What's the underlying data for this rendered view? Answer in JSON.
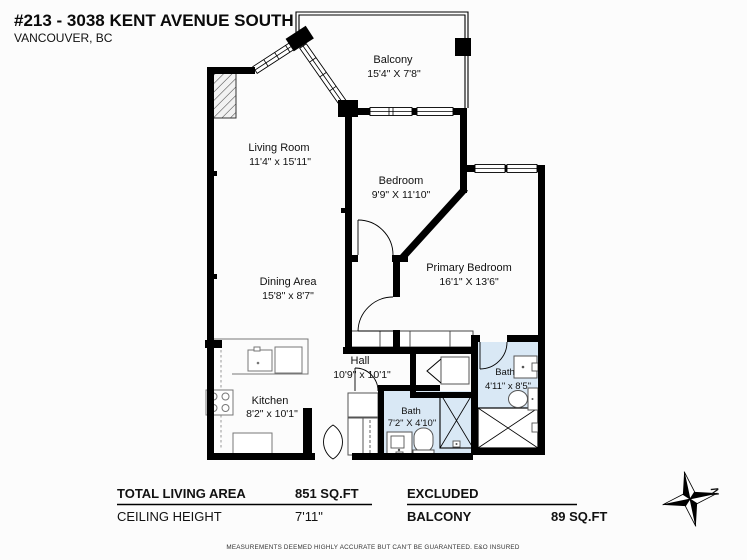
{
  "header": {
    "title": "#213 - 3038 KENT AVENUE SOUTH",
    "subtitle": "VANCOUVER, BC"
  },
  "rooms": {
    "balcony": {
      "name": "Balcony",
      "dims": "15'4\" X 7'8\""
    },
    "living": {
      "name": "Living Room",
      "dims": "11'4\" x 15'11\""
    },
    "bedroom": {
      "name": "Bedroom",
      "dims": "9'9\" X 11'10\""
    },
    "primary": {
      "name": "Primary Bedroom",
      "dims": "16'1\" X 13'6\""
    },
    "dining": {
      "name": "Dining Area",
      "dims": "15'8\" x 8'7\""
    },
    "hall": {
      "name": "Hall",
      "dims": "10'9\" x 10'1\""
    },
    "kitchen": {
      "name": "Kitchen",
      "dims": "8'2\" x 10'1\""
    },
    "bath_small": {
      "name": "Bath",
      "dims": "7'2\" X 4'10\""
    },
    "bath_main": {
      "name": "Bath",
      "dims": "4'11\" x 8'5\""
    }
  },
  "summary": {
    "total_living_area_label": "TOTAL LIVING AREA",
    "total_living_area_value": "851 SQ.FT",
    "ceiling_height_label": "CEILING HEIGHT",
    "ceiling_height_value": "7'11\"",
    "excluded_label": "EXCLUDED",
    "excluded_item_label": "BALCONY",
    "excluded_item_value": "89 SQ.FT"
  },
  "disclaimer": "MEASUREMENTS DEEMED HIGHLY ACCURATE BUT CAN'T BE GUARANTEED. E&O INSURED",
  "compass": {
    "north_label": "N"
  },
  "colors": {
    "wall": "#000000",
    "bath_floor": "#d9e8f5",
    "fixture_line": "#777777"
  }
}
